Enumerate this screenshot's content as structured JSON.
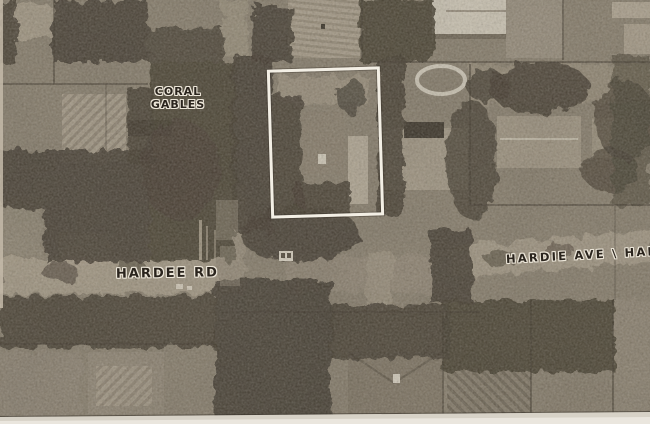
{
  "labels": {
    "city": {
      "line1": "CORAL",
      "line2": "GABLES"
    },
    "street_left": "HARDEE RD",
    "street_right": "HARDIE AVE \\ HAR"
  },
  "marker": {
    "name": "subject-parcel-outline",
    "shape": "rectangle-outline",
    "color": "#f3efe5"
  },
  "colors": {
    "photo_base": "#867d6f",
    "tree_canopy": "#3b342b",
    "road_light": "#a59b8a",
    "label_ink": "#2a241d",
    "label_halo": "#ece6d9",
    "scan_margin": "#d7d2c7"
  }
}
